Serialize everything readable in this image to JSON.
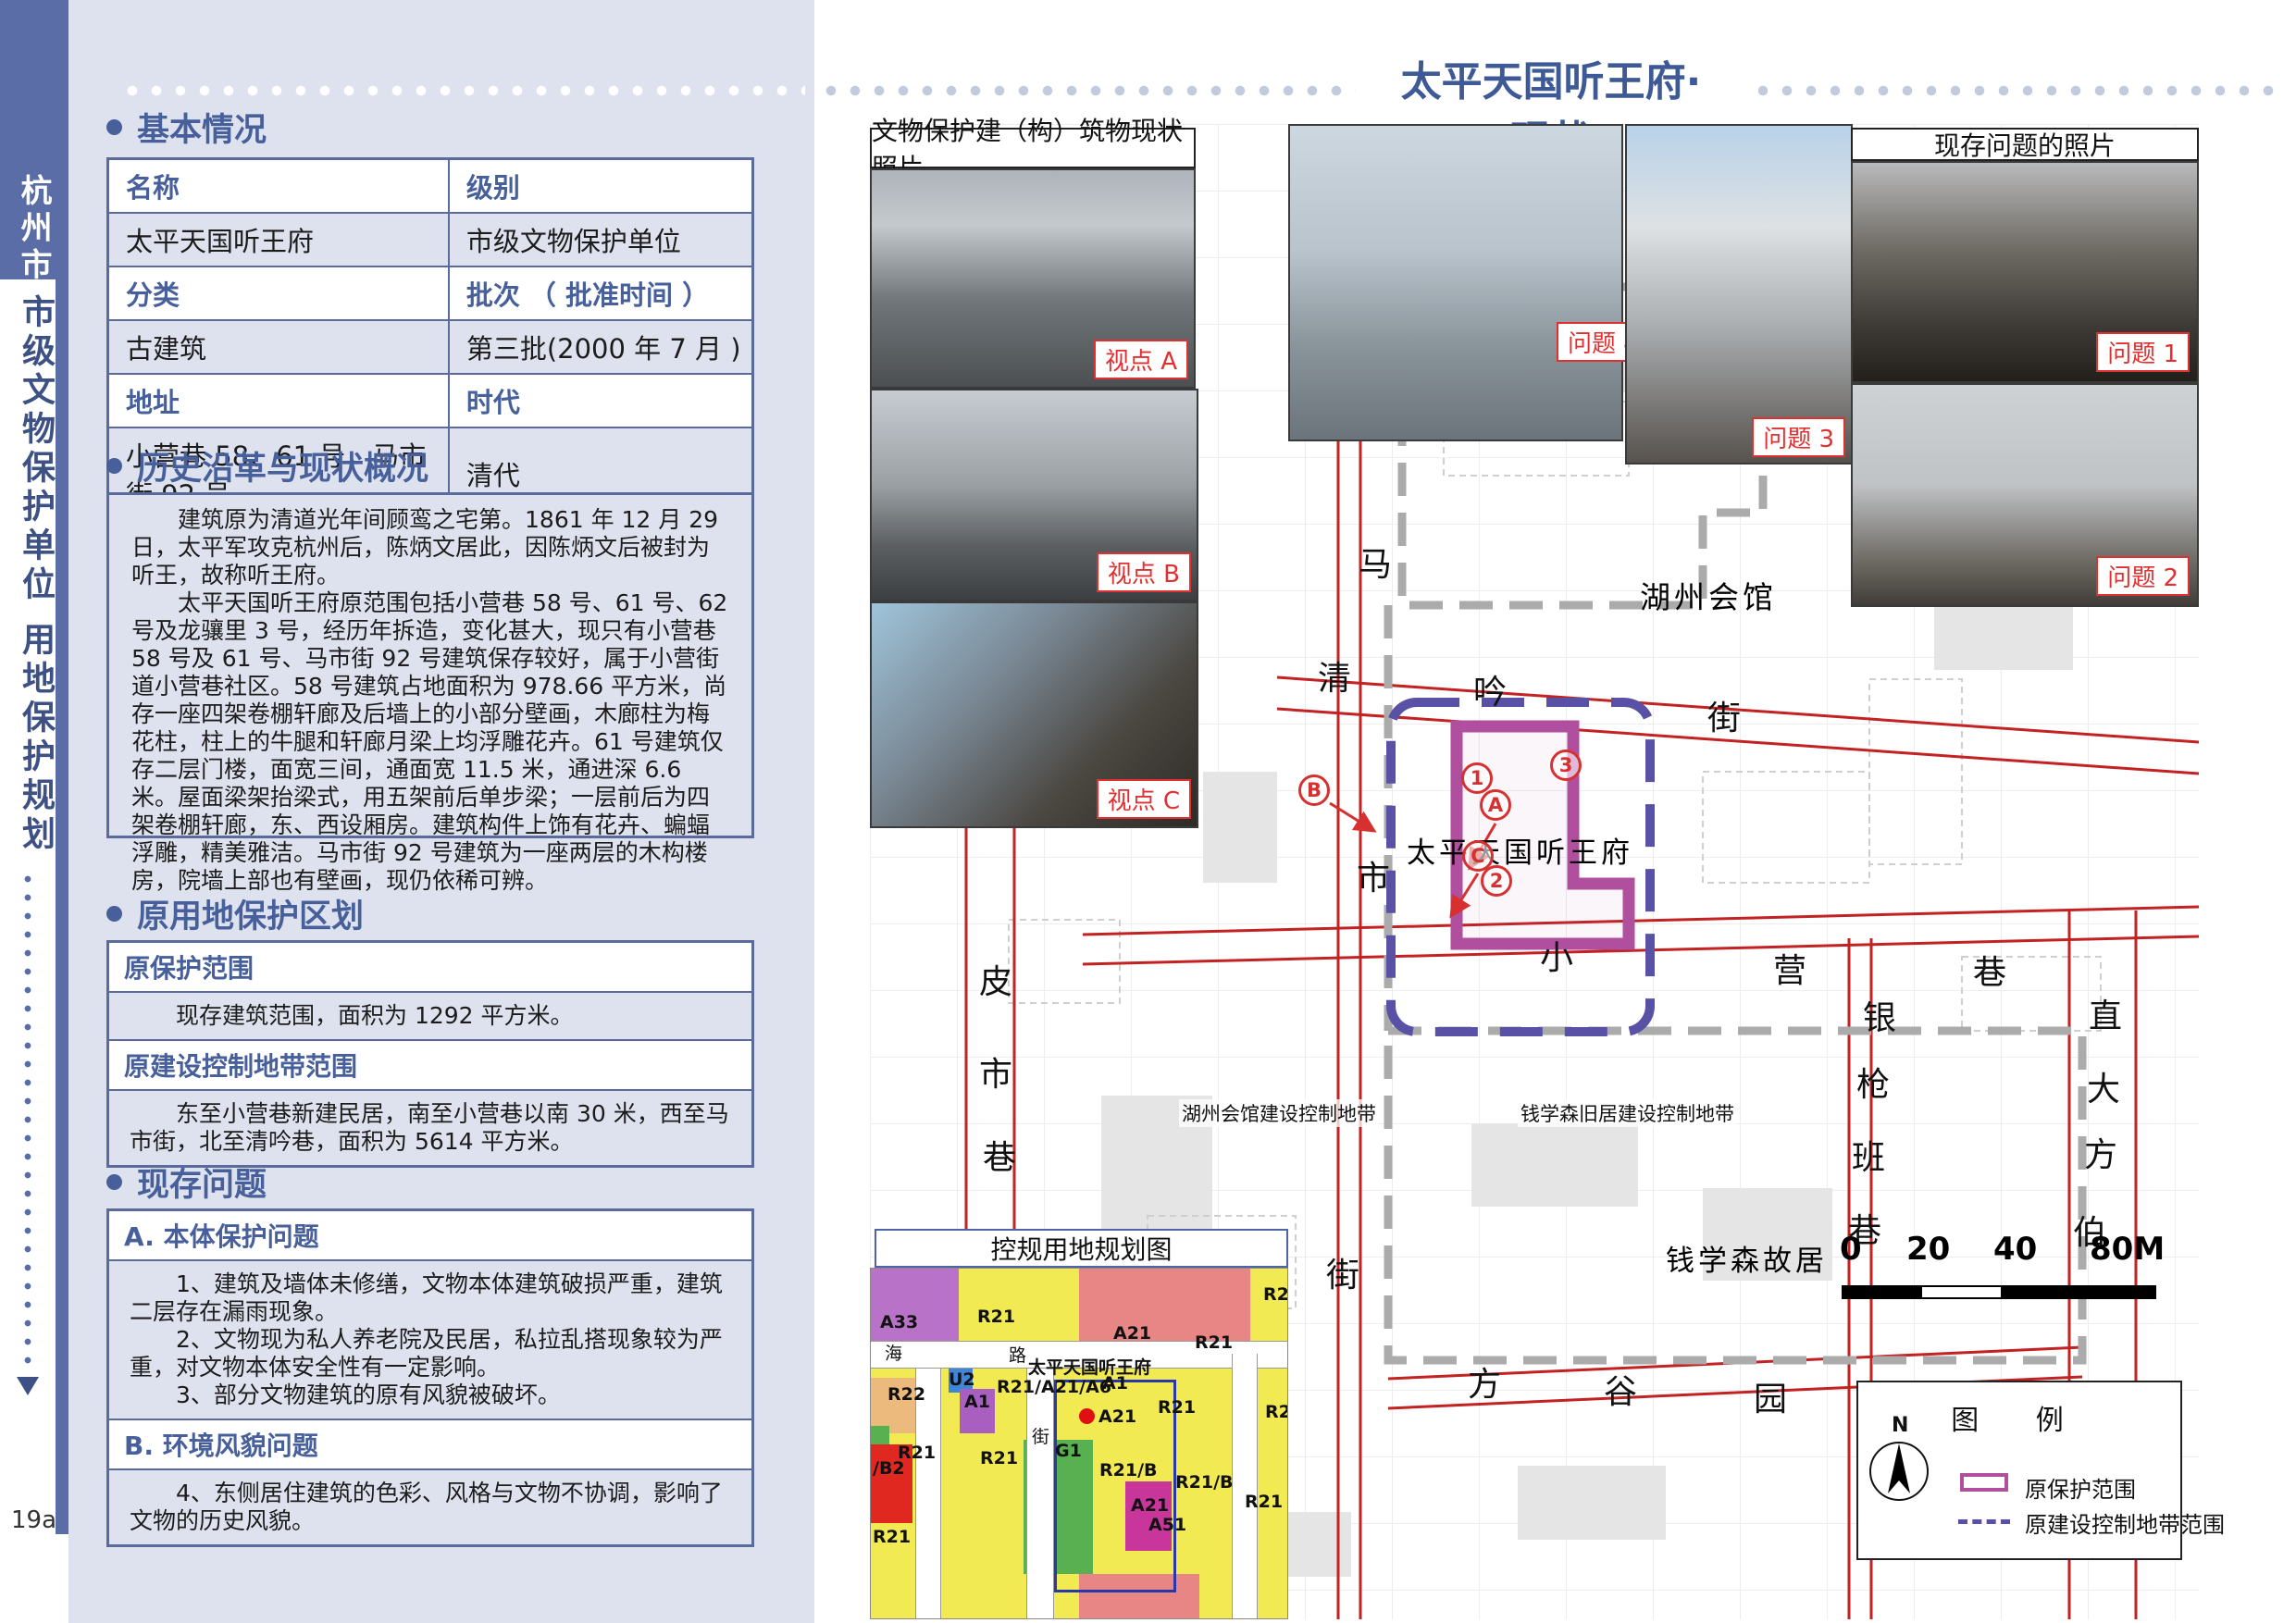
{
  "page_number": "19a",
  "sidebar": {
    "city": "杭州市",
    "line1": "市级文物保护单位",
    "line2": "用地保护规划"
  },
  "header": {
    "title": "太平天国听王府· 现状"
  },
  "basic": {
    "heading": "基本情况",
    "table": {
      "r1c1": "名称",
      "r1c2": "级别",
      "r2c1": "太平天国听王府",
      "r2c2": "市级文物保护单位",
      "r3c1": "分类",
      "r3c2": "批次 （ 批准时间 ）",
      "r4c1": "古建筑",
      "r4c2": "第三批(2000 年 7 月 )",
      "r5c1": "地址",
      "r5c2": "时代",
      "r6c1": "小营巷 58、61 号，马市街 92 号",
      "r6c2": "清代"
    }
  },
  "history": {
    "heading": "历史沿革与现状概况",
    "p1": "建筑原为清道光年间顾鸾之宅第。1861 年 12 月 29 日，太平军攻克杭州后，陈炳文居此，因陈炳文后被封为听王，故称听王府。",
    "p2": "太平天国听王府原范围包括小营巷 58 号、61 号、62 号及龙骧里 3 号，经历年拆造，变化甚大，现只有小营巷 58 号及 61 号、马市街 92 号建筑保存较好，属于小营街道小营巷社区。58 号建筑占地面积为 978.66 平方米，尚存一座四架卷棚轩廊及后墙上的小部分壁画，木廊柱为梅花柱，柱上的牛腿和轩廊月梁上均浮雕花卉。61 号建筑仅存二层门楼，面宽三间，通面宽 11.5 米，通进深 6.6 米。屋面梁架抬梁式，用五架前后单步梁；一层前后为四架卷棚轩廊，东、西设厢房。建筑构件上饰有花卉、蝙蝠浮雕，精美雅洁。马市街 92 号建筑为一座两层的木构楼房，院墙上部也有壁画，现仍依稀可辨。"
  },
  "zoning_section": {
    "heading": "原用地保护区划",
    "r1_label": "原保护范围",
    "r1_value": "现存建筑范围，面积为 1292 平方米。",
    "r2_label": "原建设控制地带范围",
    "r2_value": "东至小营巷新建民居，南至小营巷以南 30 米，西至马市街，北至清吟巷，面积为 5614 平方米。"
  },
  "problems": {
    "heading": "现存问题",
    "a_label": "A. 本体保护问题",
    "a_items": [
      "1、建筑及墙体未修缮，文物本体建筑破损严重，建筑二层存在漏雨现象。",
      "2、文物现为私人养老院及民居，私拉乱搭现象较为严重，对文物本体安全性有一定影响。",
      "3、部分文物建筑的原有风貌被破坏。"
    ],
    "b_label": "B. 环境风貌问题",
    "b_items": [
      "4、东侧居住建筑的色彩、风格与文物不协调，影响了文物的历史风貌。"
    ]
  },
  "map": {
    "photo_panel_title": "文物保护建（构）筑物现状照片",
    "problem_panel_title": "现存问题的照片",
    "viewpoint_labels": {
      "a": "视点 A",
      "b": "视点 B",
      "c": "视点 C"
    },
    "problem_labels": {
      "p1": "问题 1",
      "p2": "问题 2",
      "p3": "问题 3",
      "p4": "问题 4"
    },
    "place_labels": {
      "huzhou": "湖州会馆",
      "site": "太平天国听王府",
      "qian": "钱学森故居",
      "huzhou_zone": "湖州会馆建设控制地带",
      "qian_zone": "钱学森旧居建设控制地带"
    },
    "streets": [
      "马",
      "清",
      "吟",
      "街",
      "市",
      "小",
      "营",
      "巷",
      "皮",
      "市",
      "巷",
      "银",
      "枪",
      "班",
      "巷",
      "直",
      "大",
      "方",
      "伯",
      "街",
      "方",
      "谷",
      "园"
    ],
    "viewpoints": {
      "n1": "1",
      "n2": "2",
      "n3": "3",
      "a": "A",
      "b": "B",
      "c": "C"
    },
    "scalebar": [
      "0",
      "20",
      "40",
      "80M"
    ]
  },
  "landuse": {
    "title": "控规用地规划图",
    "labels": [
      "A33",
      "R21",
      "A21",
      "R21",
      "R2",
      "U2",
      "A1",
      "R22",
      "R21/A21/A6",
      "太平天国听王府",
      "A1",
      "A21",
      "R21",
      "R2",
      "G1",
      "R21",
      "R21",
      "/B2",
      "R21/B",
      "R21/B",
      "A21",
      "A51",
      "R21",
      "R21",
      "海",
      "路",
      "街"
    ]
  },
  "legend": {
    "title": "图 例",
    "north": "N",
    "item1": "原保护范围",
    "item2": "原建设控制地带范围"
  },
  "colors": {
    "accent_blue": "#5a6da6",
    "heading_blue": "#47609b",
    "panel_bg": "#dde2ee",
    "label_red": "#e03030",
    "protection_magenta": "#b14f9f",
    "control_purple": "#5951a6",
    "zone_gray": "#ababab",
    "road_red": "#c22222"
  }
}
